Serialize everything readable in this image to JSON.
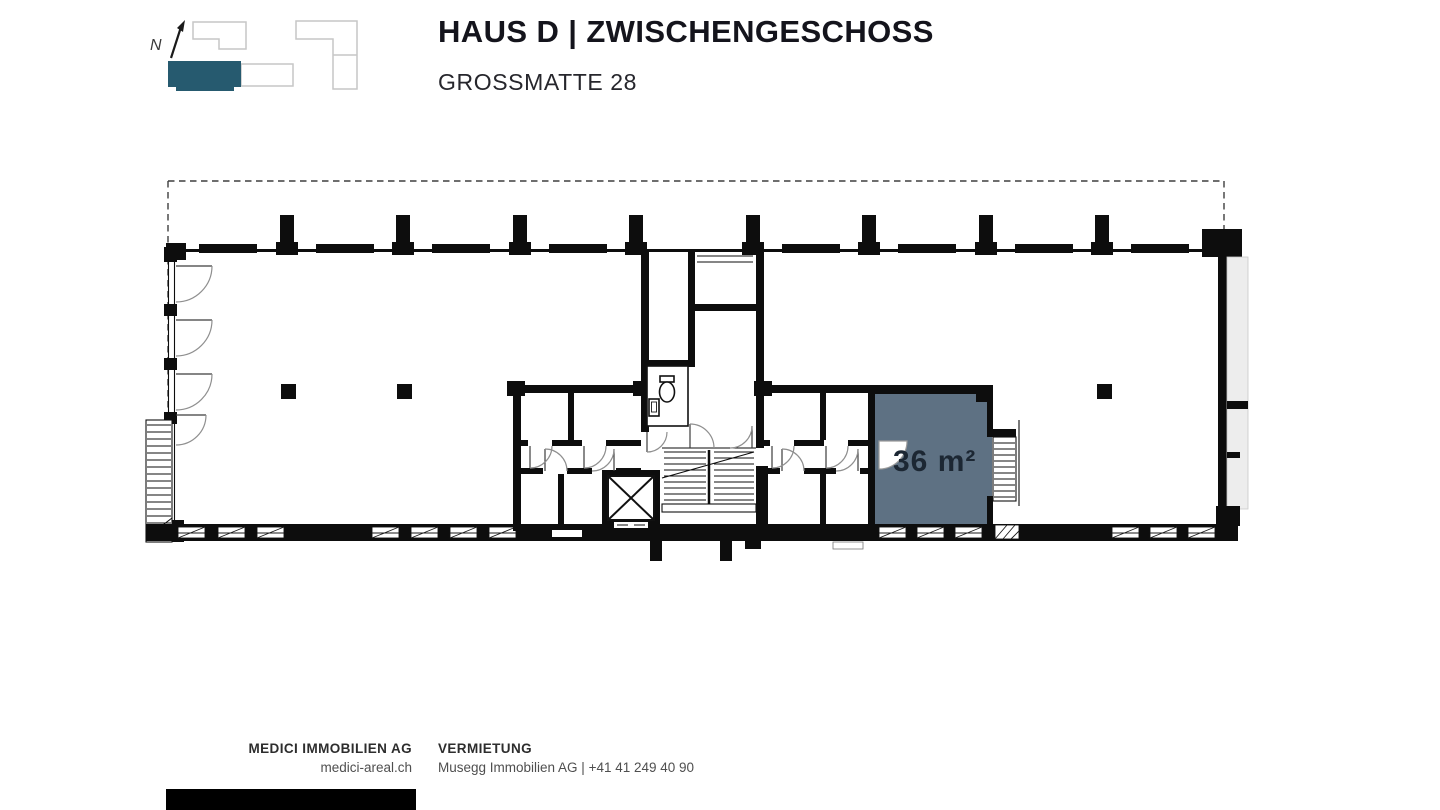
{
  "header": {
    "title": "HAUS D | ZWISCHENGESCHOSS",
    "subtitle": "GROSSMATTE 28"
  },
  "site_plan": {
    "north_label": "N",
    "highlight_color": "#265a6f"
  },
  "floor_plan": {
    "area_label": "36 m²",
    "highlight_fill": "#5e7183",
    "label_color": "#1c2733"
  },
  "footer": {
    "company_name": "MEDICI IMMOBILIEN AG",
    "company_site": "medici-areal.ch",
    "rental_heading": "VERMIETUNG",
    "rental_contact": "Musegg Immobilien AG | +41 41 249 40 90"
  }
}
